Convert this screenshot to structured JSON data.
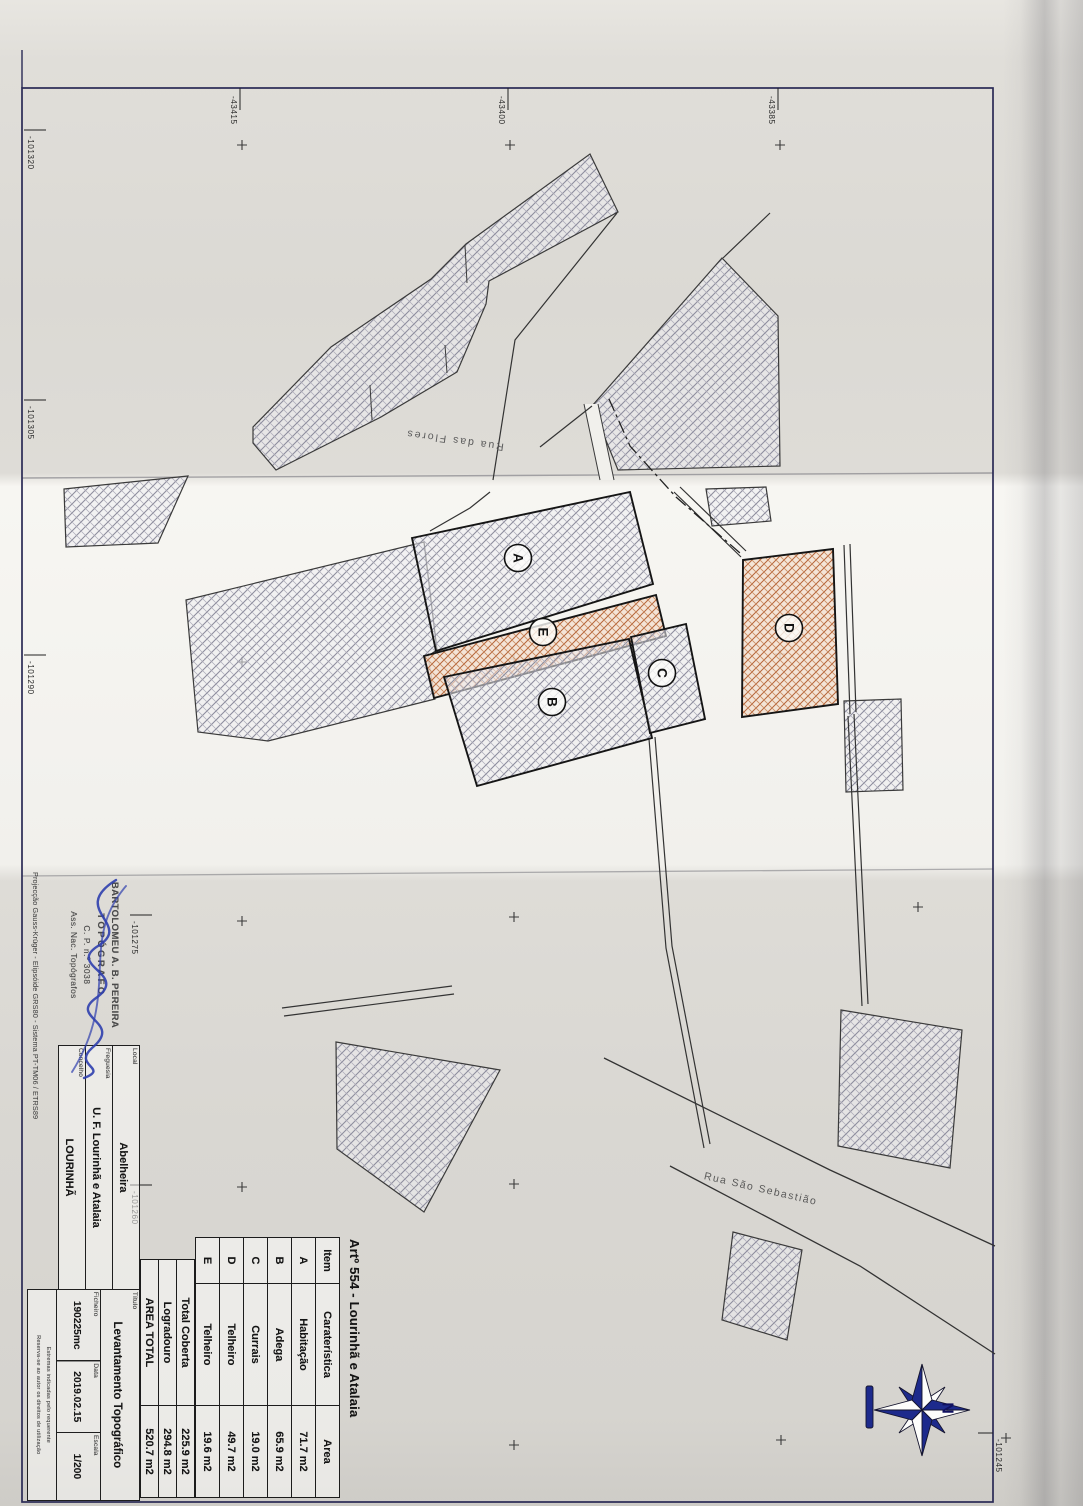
{
  "document": {
    "artigo_title": "Artº 554 - Lourinhã e Atalaia",
    "areas_table": {
      "headers": [
        "Item",
        "Caraterística",
        "Area"
      ],
      "rows": [
        {
          "item": "A",
          "caracteristica": "Habitação",
          "area": "71.7 m2"
        },
        {
          "item": "B",
          "caracteristica": "Adega",
          "area": "65.9 m2"
        },
        {
          "item": "C",
          "caracteristica": "Currais",
          "area": "19.0 m2"
        },
        {
          "item": "D",
          "caracteristica": "Telheiro",
          "area": "49.7 m2"
        },
        {
          "item": "E",
          "caracteristica": "Telheiro",
          "area": "19.6 m2"
        }
      ],
      "totals": [
        {
          "label": "Total Coberta",
          "value": "225.9 m2"
        },
        {
          "label": "Logradouro",
          "value": "294.8 m2"
        },
        {
          "label": "AREA TOTAL",
          "value": "520.7 m2"
        }
      ]
    },
    "title_block": {
      "local": {
        "label": "Local",
        "value": "Abelheira"
      },
      "freguesia": {
        "label": "Freguesia",
        "value": "U. F. Lourinhã e Atalaia"
      },
      "concelho": {
        "label": "Concelho",
        "value": "LOURINHÃ"
      },
      "titulo": {
        "label": "Título",
        "value": "Levantamento Topográfico"
      },
      "ficheiro": {
        "label": "Ficheiro",
        "value": "190225mc"
      },
      "data": {
        "label": "Data",
        "value": "2019.02.15"
      },
      "escala": {
        "label": "Escala",
        "value": "1/200"
      },
      "fine_print": [
        "Estremas indicadas pelo requerente",
        "Reserva-se ao autor os direitos de utilização"
      ]
    },
    "stamp": {
      "name": "BARTOLOMEU A. B. PEREIRA",
      "title": "TOPÓGRAFO",
      "number": "C. P. n.º 3038",
      "org": "Ass. Nac. Topógrafos"
    },
    "projection": "Projecção Gauss-Krüger - Elipsóide GRS80 - Sistema PT-TM06 / ETRS89",
    "map": {
      "streets": [
        "Rua das Flores",
        "Rua São Sebastião"
      ],
      "parcel_labels": [
        "A",
        "E",
        "B",
        "C",
        "D"
      ],
      "grid_labels_top": [
        "-43415",
        "-43400",
        "-43385"
      ],
      "grid_labels_left": [
        "-101320",
        "-101305",
        "-101290",
        "-101275",
        "-101260",
        "-101245"
      ],
      "north": "N"
    },
    "colors": {
      "hatch_gray": "#8d8d9d",
      "hatch_orange": "#b5653a",
      "frame": "#2a2a55",
      "signature_blue": "#2f3fae",
      "compass_navy": "#1d2a8c"
    }
  }
}
